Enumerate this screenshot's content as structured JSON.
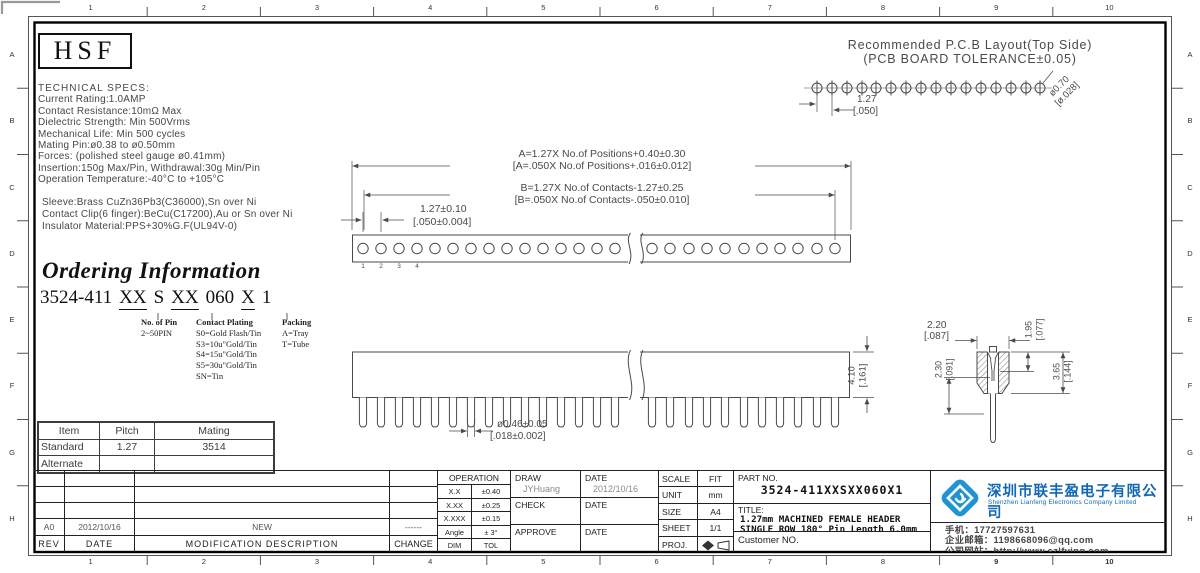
{
  "header": {
    "logo": "HSF"
  },
  "grid": {
    "cols": [
      "1",
      "2",
      "3",
      "4",
      "5",
      "6",
      "7",
      "8",
      "9",
      "10"
    ],
    "rows": [
      "A",
      "B",
      "C",
      "D",
      "E",
      "F",
      "G",
      "H"
    ]
  },
  "specs": {
    "title": "TECHNICAL SPECS:",
    "lines": [
      "Current Rating:1.0AMP",
      "Contact Resistance:10mΩ Max",
      "Dielectric Strength: Min 500Vrms",
      "Mechanical Life: Min 500 cycles",
      "Mating Pin:ø0.38 to ø0.50mm",
      "Forces: (polished steel gauge ø0.41mm)",
      "Insertion:150g Max/Pin, Withdrawal:30g Min/Pin",
      "Operation Temperature:-40°C to +105°C"
    ],
    "materials": [
      "Sleeve:Brass CuZn36Pb3(C36000),Sn over Ni",
      "Contact Clip(6 finger):BeCu(C17200),Au or Sn over Ni",
      "Insulator Material:PPS+30%G.F(UL94V-0)"
    ]
  },
  "pcb": {
    "title1": "Recommended P.C.B Layout(Top Side)",
    "title2": "(PCB BOARD TOLERANCE±0.05)",
    "pitch_mm": "1.27",
    "pitch_in": "[.050]",
    "hole_mm": "ø0.70",
    "hole_in": "[ø.028]"
  },
  "dims": {
    "a1": "A=1.27X No.of Positions+0.40±0.30",
    "a2": "[A=.050X No.of Positions+.016±0.012]",
    "b1": "B=1.27X No.of Contacts-1.27±0.25",
    "b2": "[B=.050X No.of Contacts-.050±0.010]",
    "pitch1": "1.27±0.10",
    "pitch2": "[.050±0.004]",
    "pins": [
      "1",
      "2",
      "3",
      "4"
    ],
    "tail1": "ø0.46±0.05",
    "tail2": "[.018±0.002]",
    "height1": "4.10",
    "height2": "[.161]",
    "detail_width1": "2.20",
    "detail_width2": "[.087]",
    "detail_d1a": "1.95",
    "detail_d1b": "[.077]",
    "detail_d2a": "2.30",
    "detail_d2b": "[.091]",
    "detail_d3a": "3.65",
    "detail_d3b": "[.144]"
  },
  "ordering": {
    "heading": "Ordering Information",
    "pn_prefix": "3524-411",
    "pn_x1": "XX",
    "pn_s": "S",
    "pn_x2": "XX",
    "pn_060": "060",
    "pn_x3": "X",
    "pn_1": "1",
    "col1_title": "No. of Pin",
    "col1_sub": "2~50PIN",
    "col2_title": "Contact Plating",
    "col2_items": [
      "S0=Gold Flash/Tin",
      "S3=10u\"Gold/Tin",
      "S4=15u\"Gold/Tin",
      "S5=30u\"Gold/Tin",
      "SN=Tin"
    ],
    "col3_title": "Packing",
    "col3_items": [
      "A=Tray",
      "T=Tube"
    ]
  },
  "mating_table": {
    "headers": [
      "Item",
      "Pitch",
      "Mating"
    ],
    "rows": [
      [
        "Standard",
        "1.27",
        "3514"
      ],
      [
        "Alternate",
        "",
        ""
      ]
    ]
  },
  "revision": {
    "rev": "A0",
    "date": "2012/10/16",
    "desc": "NEW",
    "change": "------",
    "h_rev": "REV",
    "h_date": "DATE",
    "h_desc": "MODIFICATION  DESCRIPTION",
    "h_change": "CHANGE"
  },
  "tolerance": {
    "header": "OPERATION",
    "rows": [
      [
        "X.X",
        "±0.40"
      ],
      [
        "X.XX",
        "±0.25"
      ],
      [
        "X.XXX",
        "±0.15"
      ],
      [
        "Angle",
        "± 3°"
      ],
      [
        "DIM",
        "TOL"
      ]
    ]
  },
  "approval": {
    "draw_label": "DRAW",
    "draw_value": "JYHuang",
    "date_label": "DATE",
    "date_value": "2012/10/16",
    "check_label": "CHECK",
    "approve_label": "APPROVE"
  },
  "info": {
    "scale_label": "SCALE",
    "scale": "FIT",
    "unit_label": "UNIT",
    "unit": "mm",
    "size_label": "SIZE",
    "size": "A4",
    "sheet_label": "SHEET",
    "sheet": "1/1",
    "proj_label": "PROJ."
  },
  "part": {
    "part_no_label": "PART NO.",
    "part_no": "3524-411XXSXX060X1",
    "title_label": "TITLE:",
    "title_line1": "1.27mm MACHINED FEMALE HEADER",
    "title_line2": "SINGLE ROW 180° Pin Length 6.0mm",
    "customer": "Customer NO."
  },
  "company": {
    "name_cn": "深圳市联丰盈电子有限公司",
    "name_en": "Shenzhen Lianfeng Electronics Company Limited",
    "phone": "手机：17727597631",
    "email": "企业邮箱：1198668096@qq.com",
    "website": "公司网站：http://www.szlfying.com"
  },
  "colors": {
    "brand_blue": "#1268b3",
    "logo_blue": "#2093d5",
    "line_gray": "#4a4a4a"
  }
}
